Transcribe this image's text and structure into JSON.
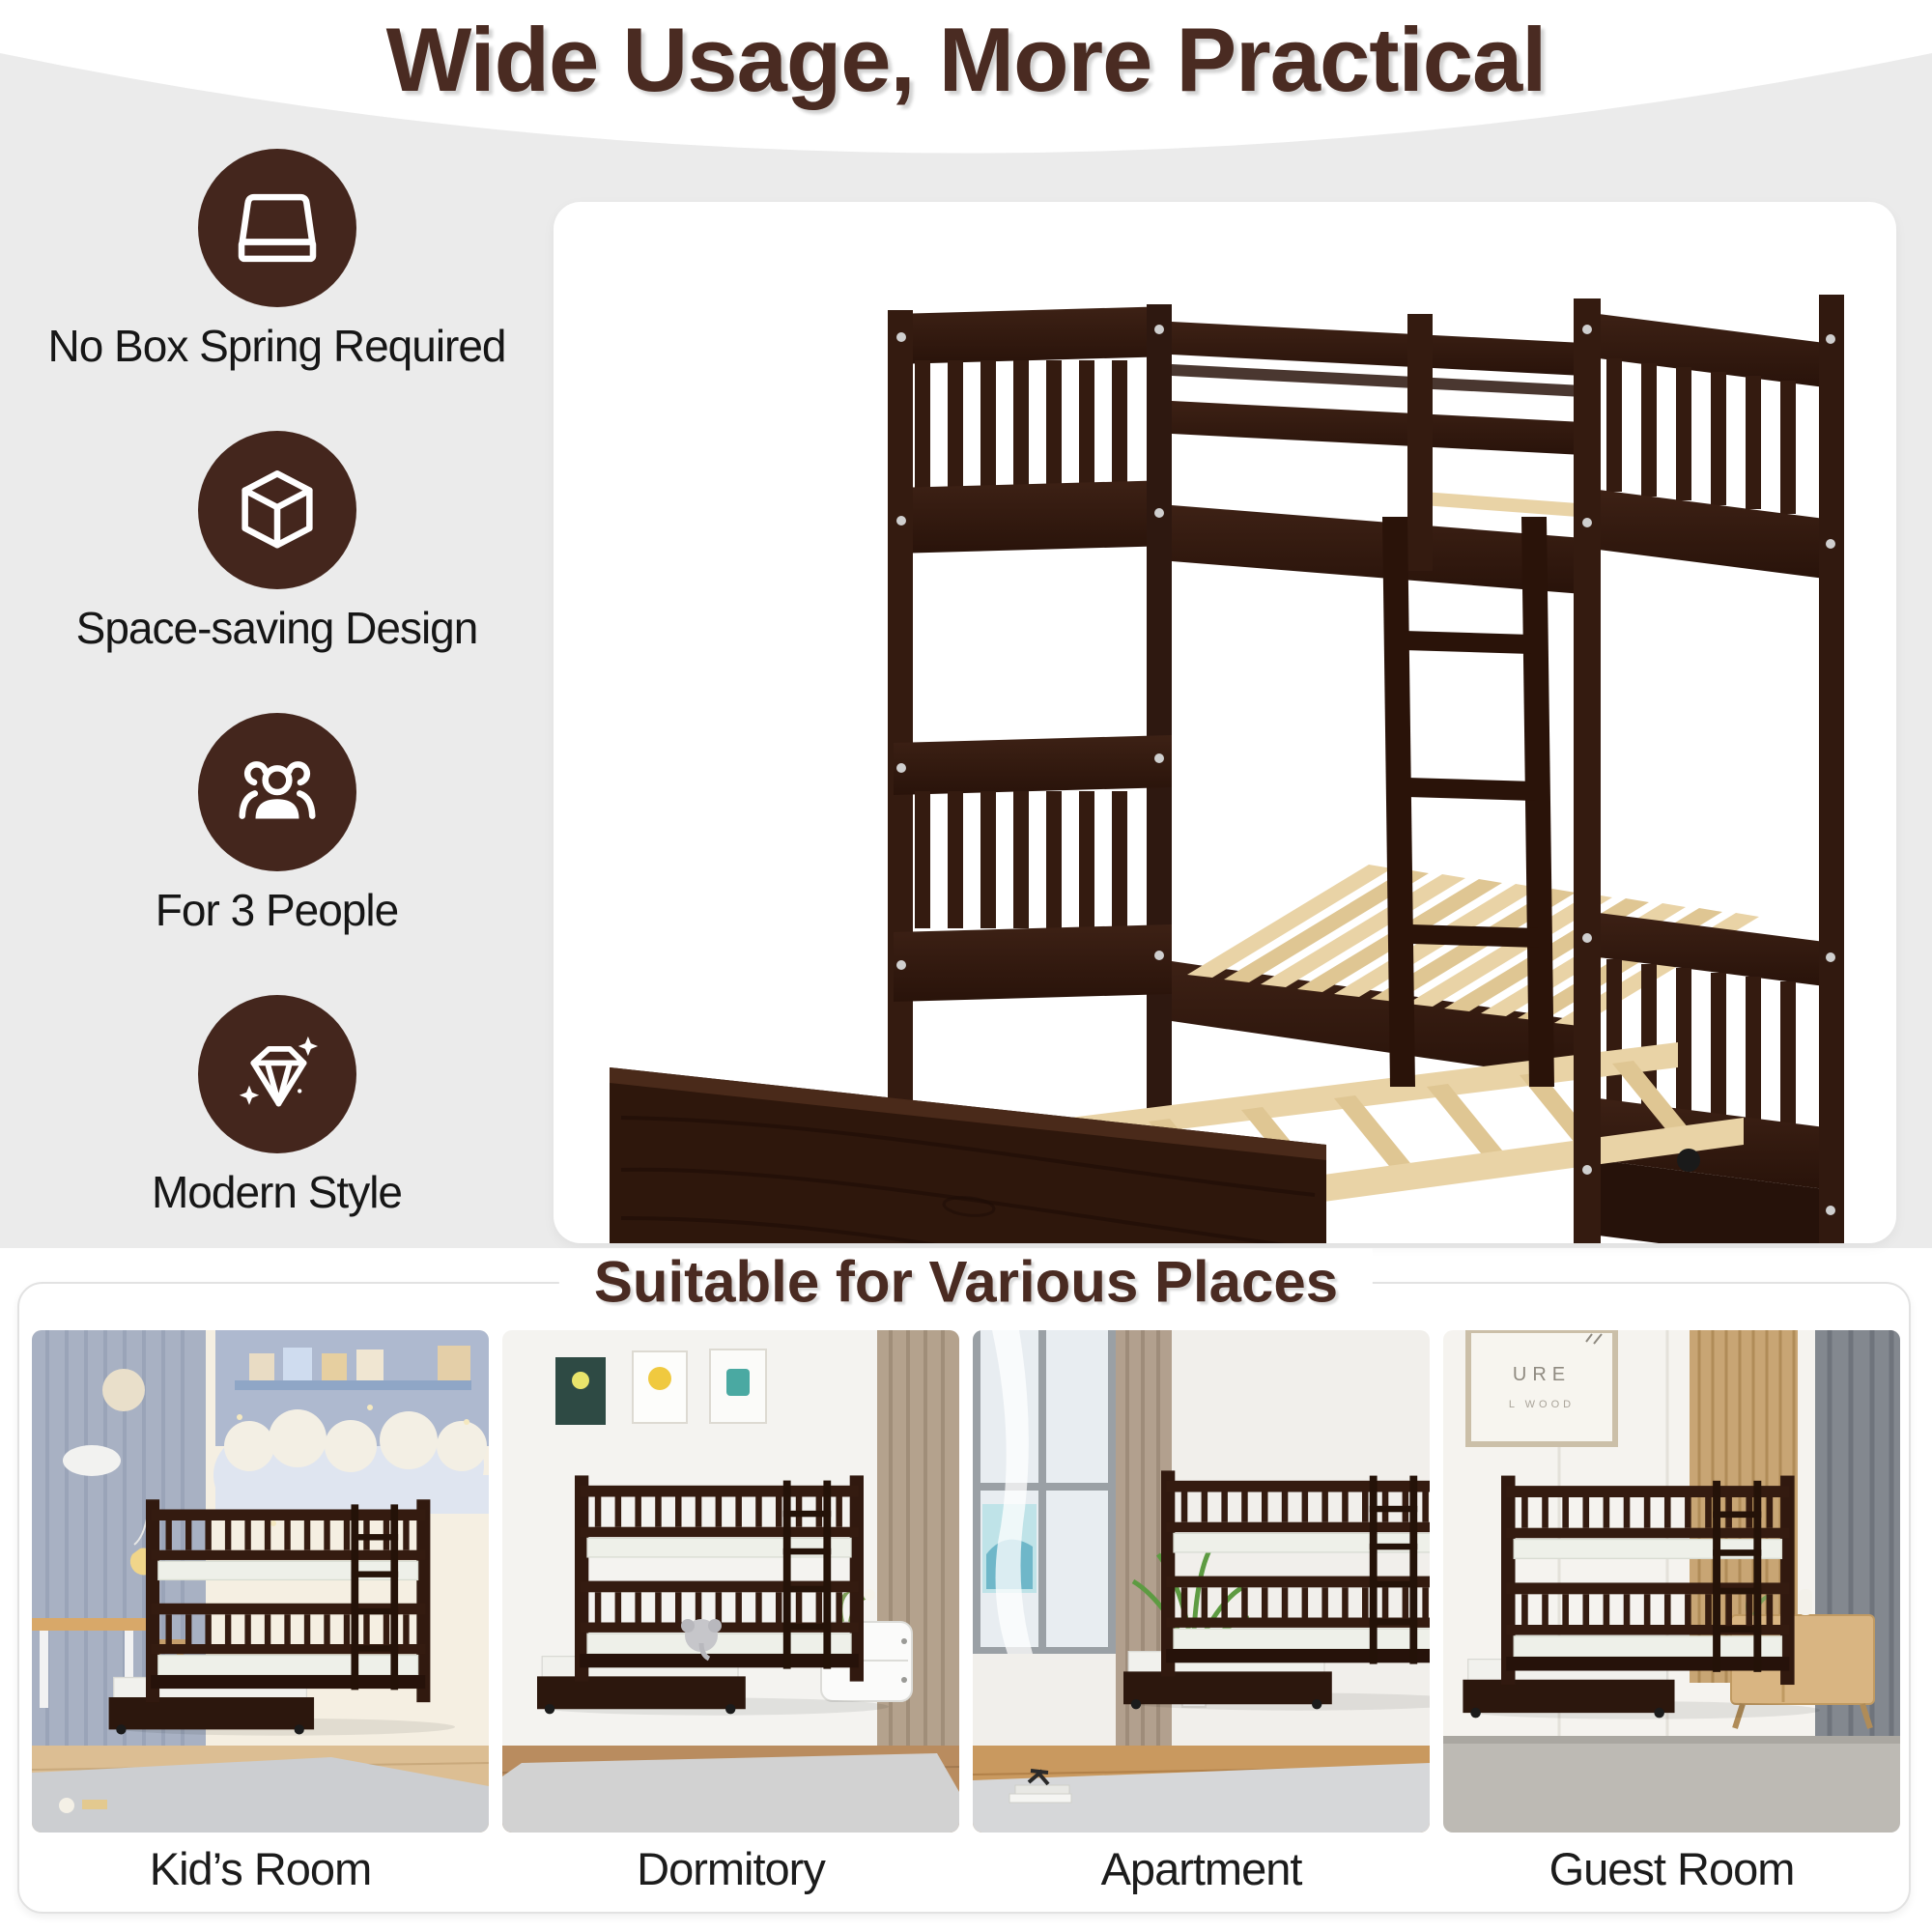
{
  "header": {
    "title": "Wide Usage, More Practical"
  },
  "features": [
    {
      "icon": "mattress-icon",
      "label": "No Box Spring Required"
    },
    {
      "icon": "cube-icon",
      "label": "Space-saving Design"
    },
    {
      "icon": "people-icon",
      "label": "For 3 People"
    },
    {
      "icon": "diamond-icon",
      "label": "Modern Style"
    }
  ],
  "product": {
    "alt": "Espresso twin-over-twin wood bunk bed with slatted guardrails, side ladder and pull-out trundle bed on casters"
  },
  "section": {
    "title": "Suitable for Various Places"
  },
  "places": [
    {
      "label": "Kid’s Room"
    },
    {
      "label": "Dormitory"
    },
    {
      "label": "Apartment"
    },
    {
      "label": "Guest Room"
    }
  ],
  "guest_frame": {
    "line1": "URE",
    "line2": "L WOOD"
  },
  "colors": {
    "brand_brown": "#44261d",
    "title_brown": "#4a2b22",
    "background_gray": "#ebebeb",
    "bed_espresso": "#341b10",
    "slat_wood": "#e9d3a6"
  }
}
